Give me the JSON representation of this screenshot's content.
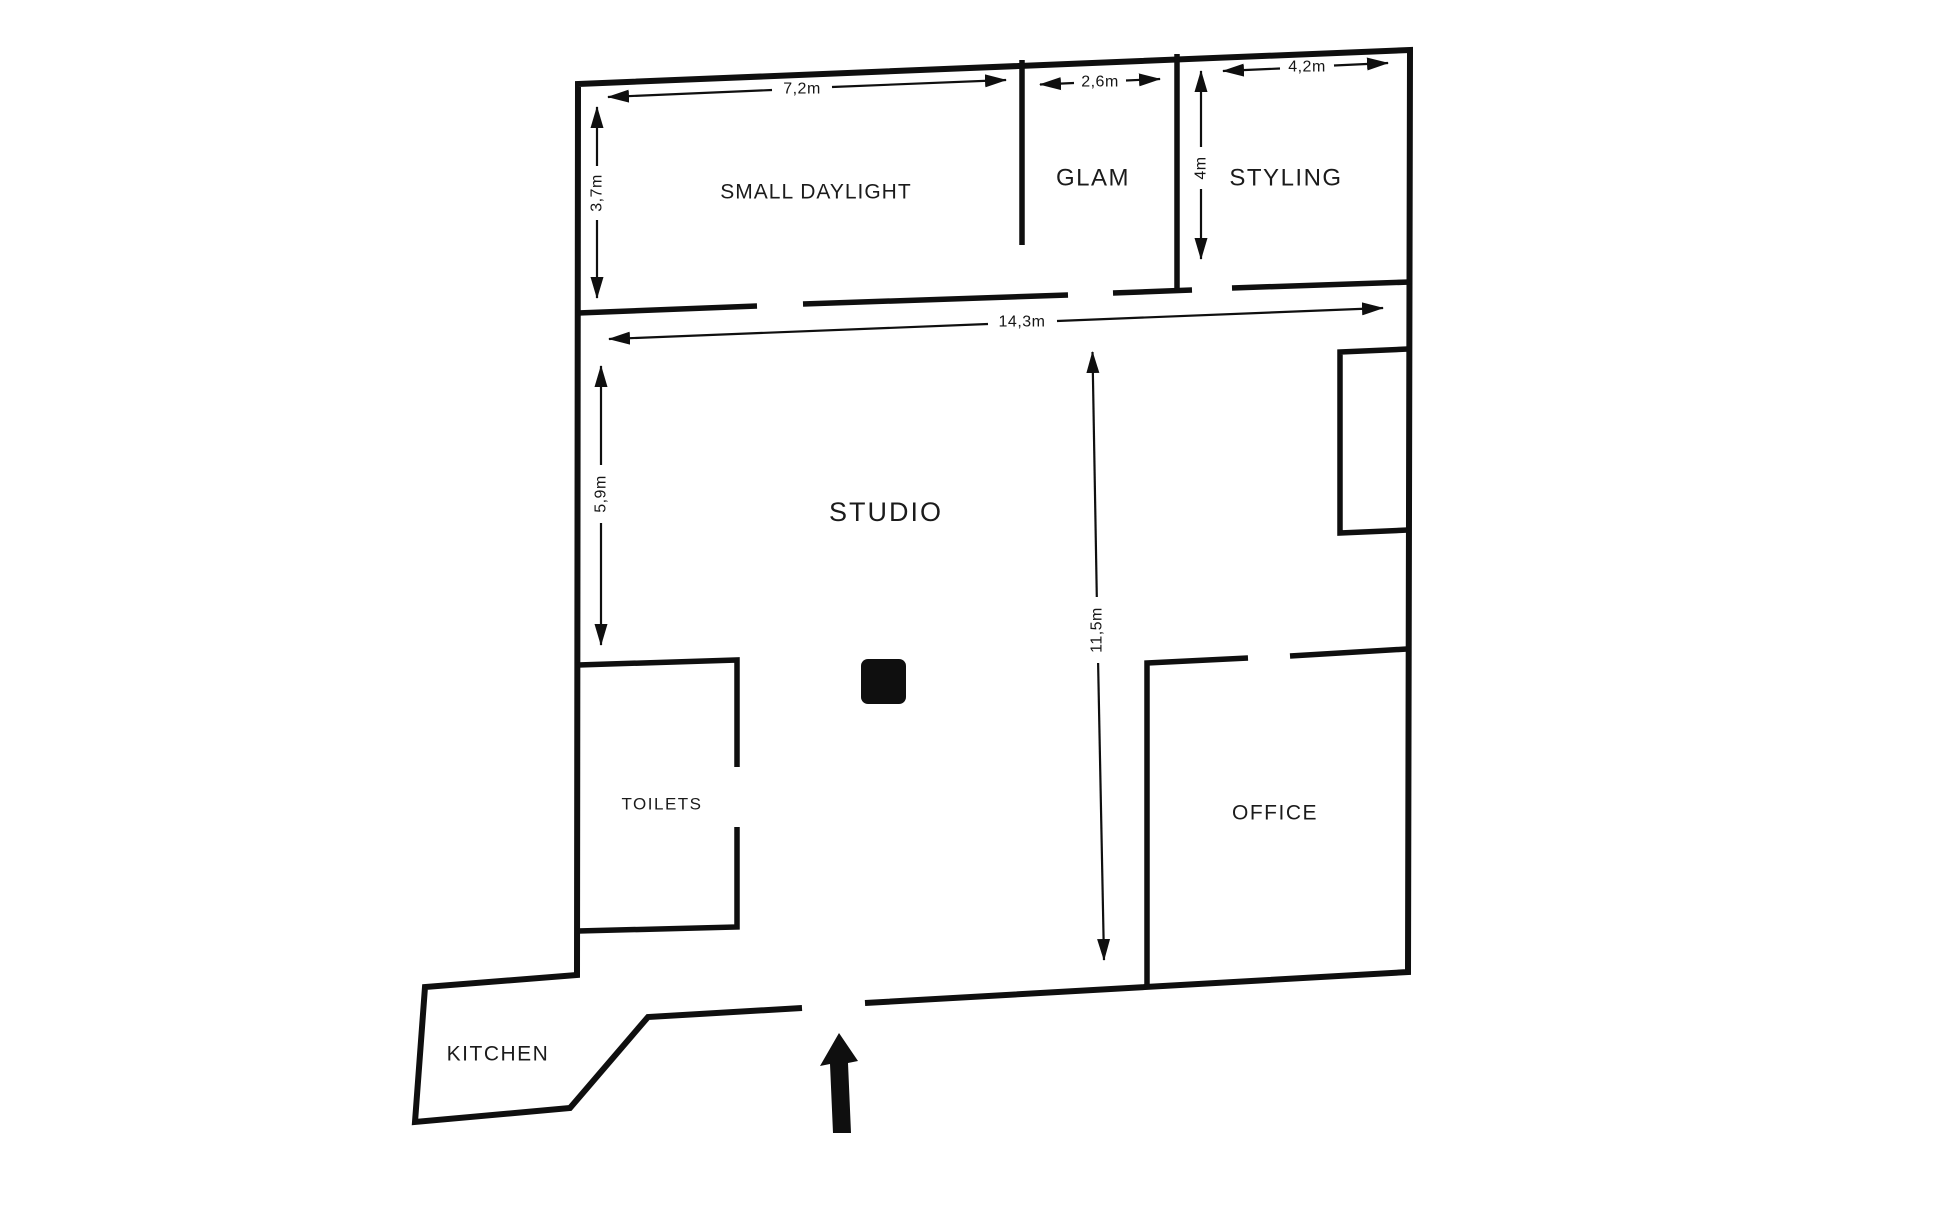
{
  "title": "Photo studio floor plan",
  "colors": {
    "background": "#ffffff",
    "ink": "#0f0f0f"
  },
  "rooms": {
    "small_daylight": {
      "label": "SMALL DAYLIGHT"
    },
    "glam": {
      "label": "GLAM"
    },
    "styling": {
      "label": "STYLING"
    },
    "studio": {
      "label": "STUDIO"
    },
    "toilets": {
      "label": "TOILETS"
    },
    "office": {
      "label": "OFFICE"
    },
    "kitchen": {
      "label": "KITCHEN"
    }
  },
  "dimensions": {
    "small_daylight_width": {
      "label": "7,2m"
    },
    "small_daylight_height": {
      "label": "3,7m"
    },
    "glam_width": {
      "label": "2,6m"
    },
    "styling_width": {
      "label": "4,2m"
    },
    "styling_height": {
      "label": "4m"
    },
    "studio_width": {
      "label": "14,3m"
    },
    "studio_height_left": {
      "label": "5,9m"
    },
    "studio_height_right": {
      "label": "11,5m"
    }
  },
  "symbols": {
    "entrance_arrow": "arrow-up",
    "pillar": "filled-rounded-square"
  }
}
